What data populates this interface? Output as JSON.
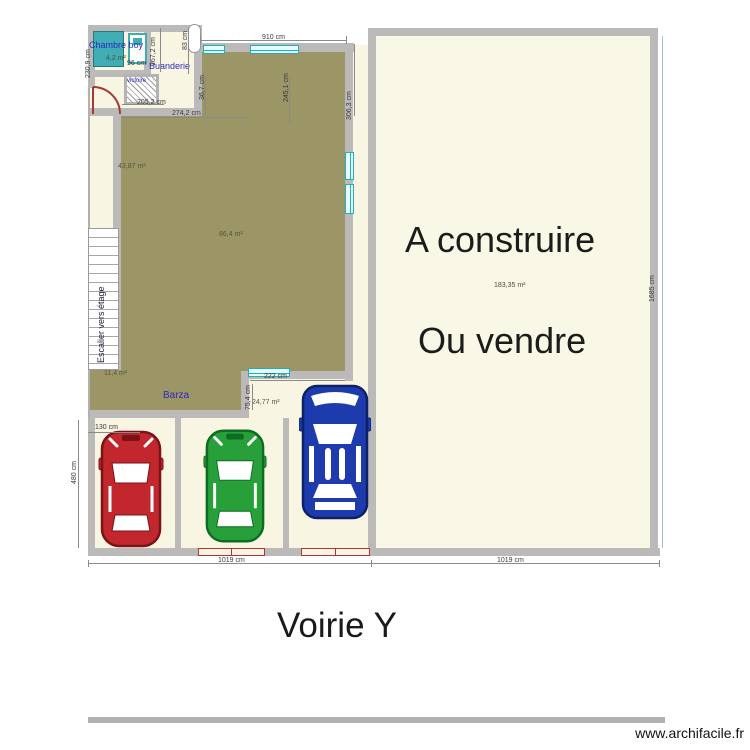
{
  "plan": {
    "room_labels": {
      "chambre_boy": "Chambre boy",
      "buanderie": "Buanderie",
      "barza": "Barza",
      "wc_small": "victoire"
    },
    "stairs_label": "Escalier vers étage",
    "area_labels": {
      "chambre_boy": "4,2 m²",
      "living": "86,4 m²",
      "left_wing": "43,87 m²",
      "stairs": "11,4 m²",
      "terrace": "24,77 m²",
      "parcel_right": "183,35 m²"
    },
    "dimension_labels": {
      "top_width": "910 cm",
      "top_right_height": "306,3 cm",
      "chambre_height": "230,9 cm",
      "bed_width": "96 cm",
      "buanderie_height": "167,2 cm",
      "door_width": "83 cm",
      "wall_small": "36,7 cm",
      "buanderie_depth": "245,1 cm",
      "corridor_width": "205,2 cm",
      "hall_width": "274,2 cm",
      "terrace_width": "222 cm",
      "terrace_height": "75,4 cm",
      "stall_width": "130 cm",
      "parking_height": "480 cm",
      "street_left": "1019 cm",
      "street_right": "1019 cm",
      "parcel_right_height": "1685 cm"
    },
    "parcel_right_text": {
      "line1": "A construire",
      "line2": "Ou vendre"
    },
    "street_label": "Voirie Y",
    "watermark": "www.archifacile.fr",
    "colors": {
      "floor": "#f8f5e2",
      "roof": "#9c9566",
      "wall": "#bcb9b9",
      "window": "#21aebe",
      "furniture_teal": "#3fadb3",
      "door_red": "#a23c32",
      "car_red": "#c1272d",
      "car_green": "#28a03a",
      "car_blue": "#1d3bad",
      "room_label_blue": "#2b2bbd"
    }
  }
}
